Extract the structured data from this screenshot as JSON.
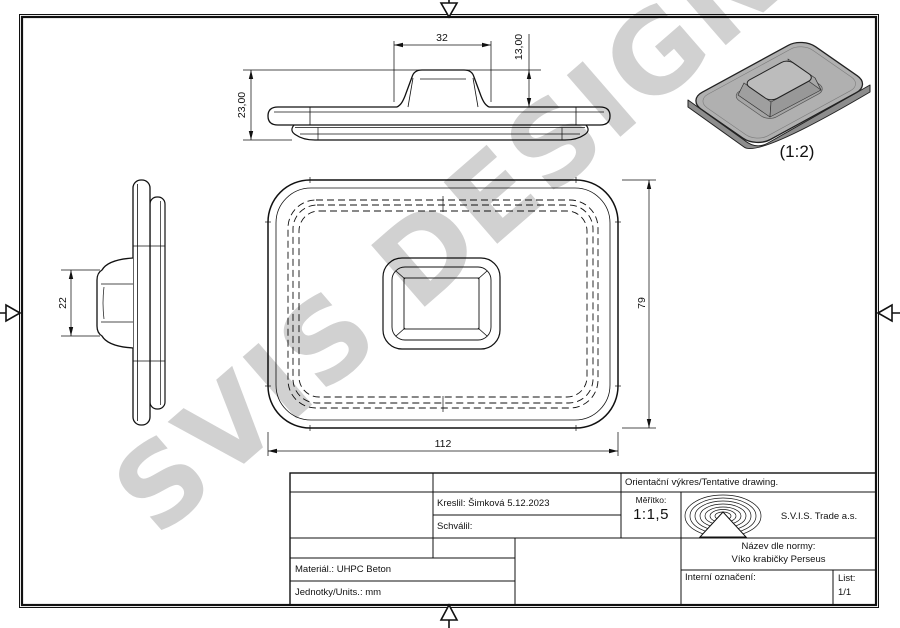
{
  "watermark": {
    "text": "SVIS DESIGN"
  },
  "colors": {
    "line": "#111111",
    "watermark": "#a6a6a6",
    "iso_fill": "#b0b0b0"
  },
  "views": {
    "front": {
      "dims": {
        "knob_width": "32",
        "knob_height": "13,00",
        "total_height": "23,00"
      }
    },
    "side": {
      "dims": {
        "knob_height": "22"
      }
    },
    "plan": {
      "dims": {
        "width": "112",
        "height": "79"
      }
    },
    "iso": {
      "scale_label": "(1:2)"
    }
  },
  "title_block": {
    "tentative": "Orientační výkres/Tentative drawing.",
    "kreslil": "Kreslil: Šimková 5.12.2023",
    "schvalil": "Schválil:",
    "meritko_label": "Měřítko:",
    "meritko_value": "1:1,5",
    "company": "S.V.I.S. Trade a.s.",
    "nazev_label": "Název dle normy:",
    "nazev_value": "Víko krabičky Perseus",
    "interni": "Interní označení:",
    "list_label": "List:",
    "list_value": "1/1",
    "material": "Materiál.: UHPC Beton",
    "jednotky": "Jednotky/Units.: mm"
  }
}
